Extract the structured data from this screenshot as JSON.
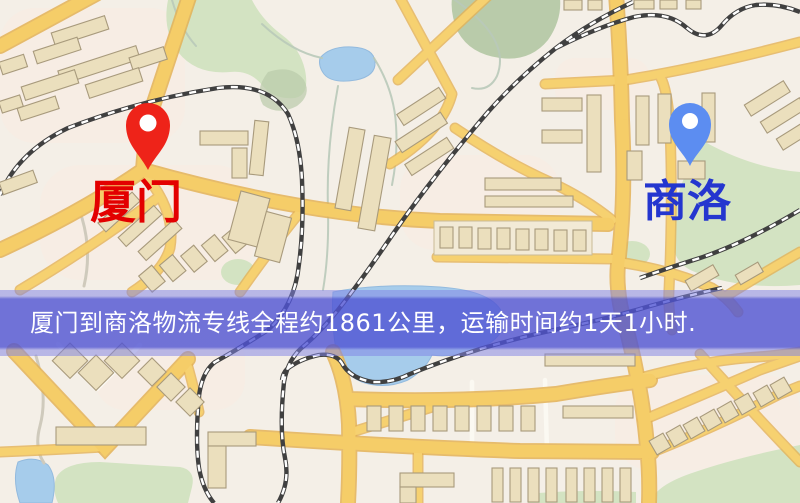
{
  "route_map": {
    "origin": {
      "name": "厦门",
      "label_color": "#e30000",
      "pin_color": "#ee2319"
    },
    "destination": {
      "name": "商洛",
      "label_color": "#2436cf",
      "pin_color": "#5c8df1"
    },
    "banner": {
      "text": "厦门到商洛物流专线全程约1861公里，运输时间约1天1小时.",
      "distance_km": "1861",
      "duration": "1天1小时",
      "overlay_color": "#585cd6",
      "text_color": "#ffffff"
    },
    "palette": {
      "background": "#f4efe7",
      "road": "#f5cd68",
      "road_casing": "#e3b156",
      "water": "#a6cceb",
      "park": "#d3e3c2",
      "building": "#ebdfbd",
      "building_outline": "#a89a7c",
      "railway": "#404040"
    }
  }
}
